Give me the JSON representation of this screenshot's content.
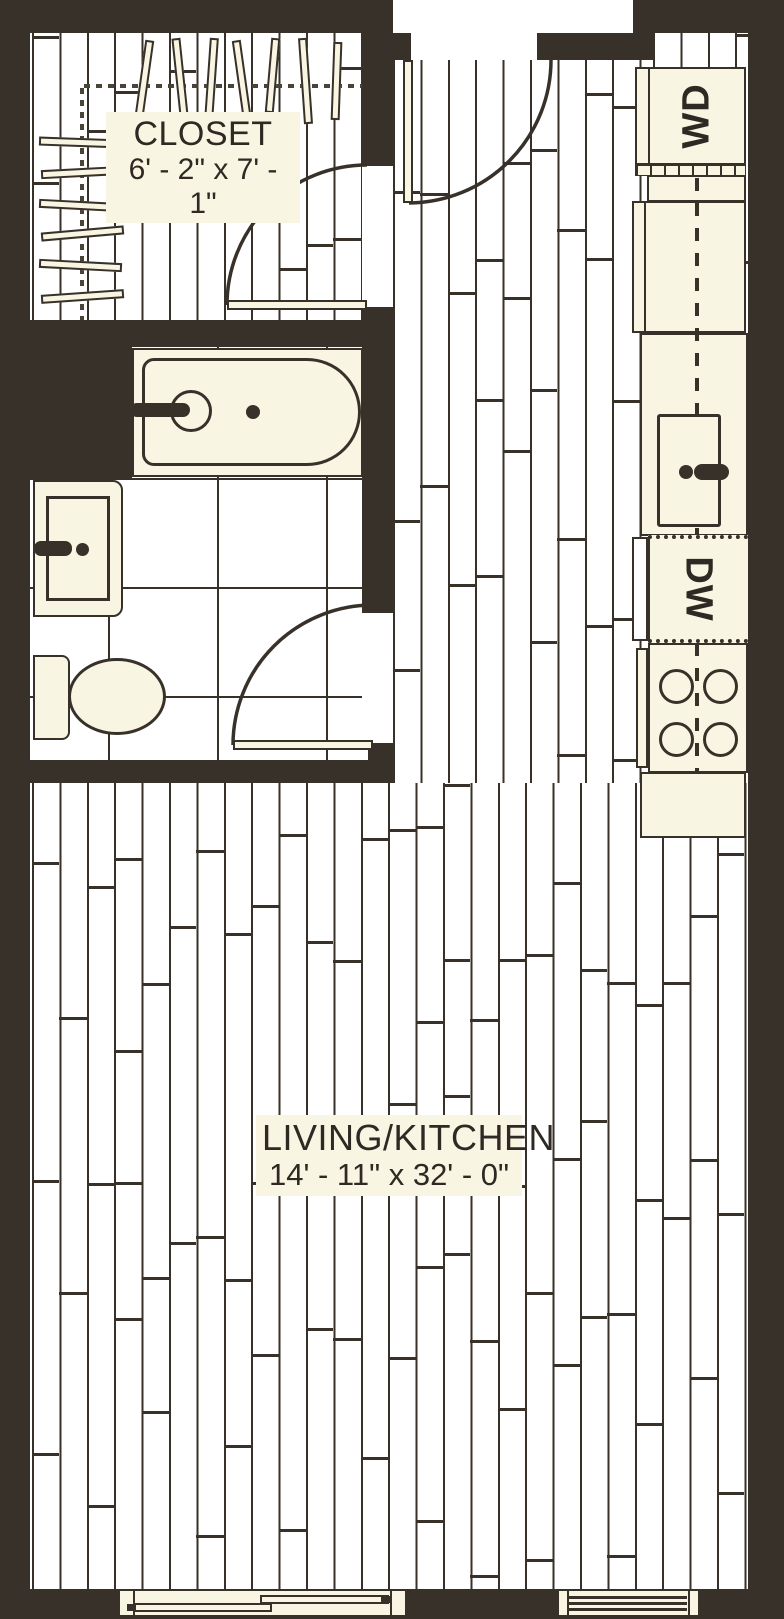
{
  "rooms": {
    "closet": {
      "label": "CLOSET",
      "dimensions": "6' - 2\" x 7' - 1\""
    },
    "living_kitchen": {
      "label": "LIVING/KITCHEN",
      "dimensions": "14' - 11\" x 32' - 0\""
    }
  },
  "appliances": {
    "washer_dryer": "WD",
    "dishwasher": "DW"
  },
  "legend_colors": {
    "wall": "#37312A",
    "fixture_fill": "#F9F5E3",
    "floor": "#FFFFFF"
  }
}
